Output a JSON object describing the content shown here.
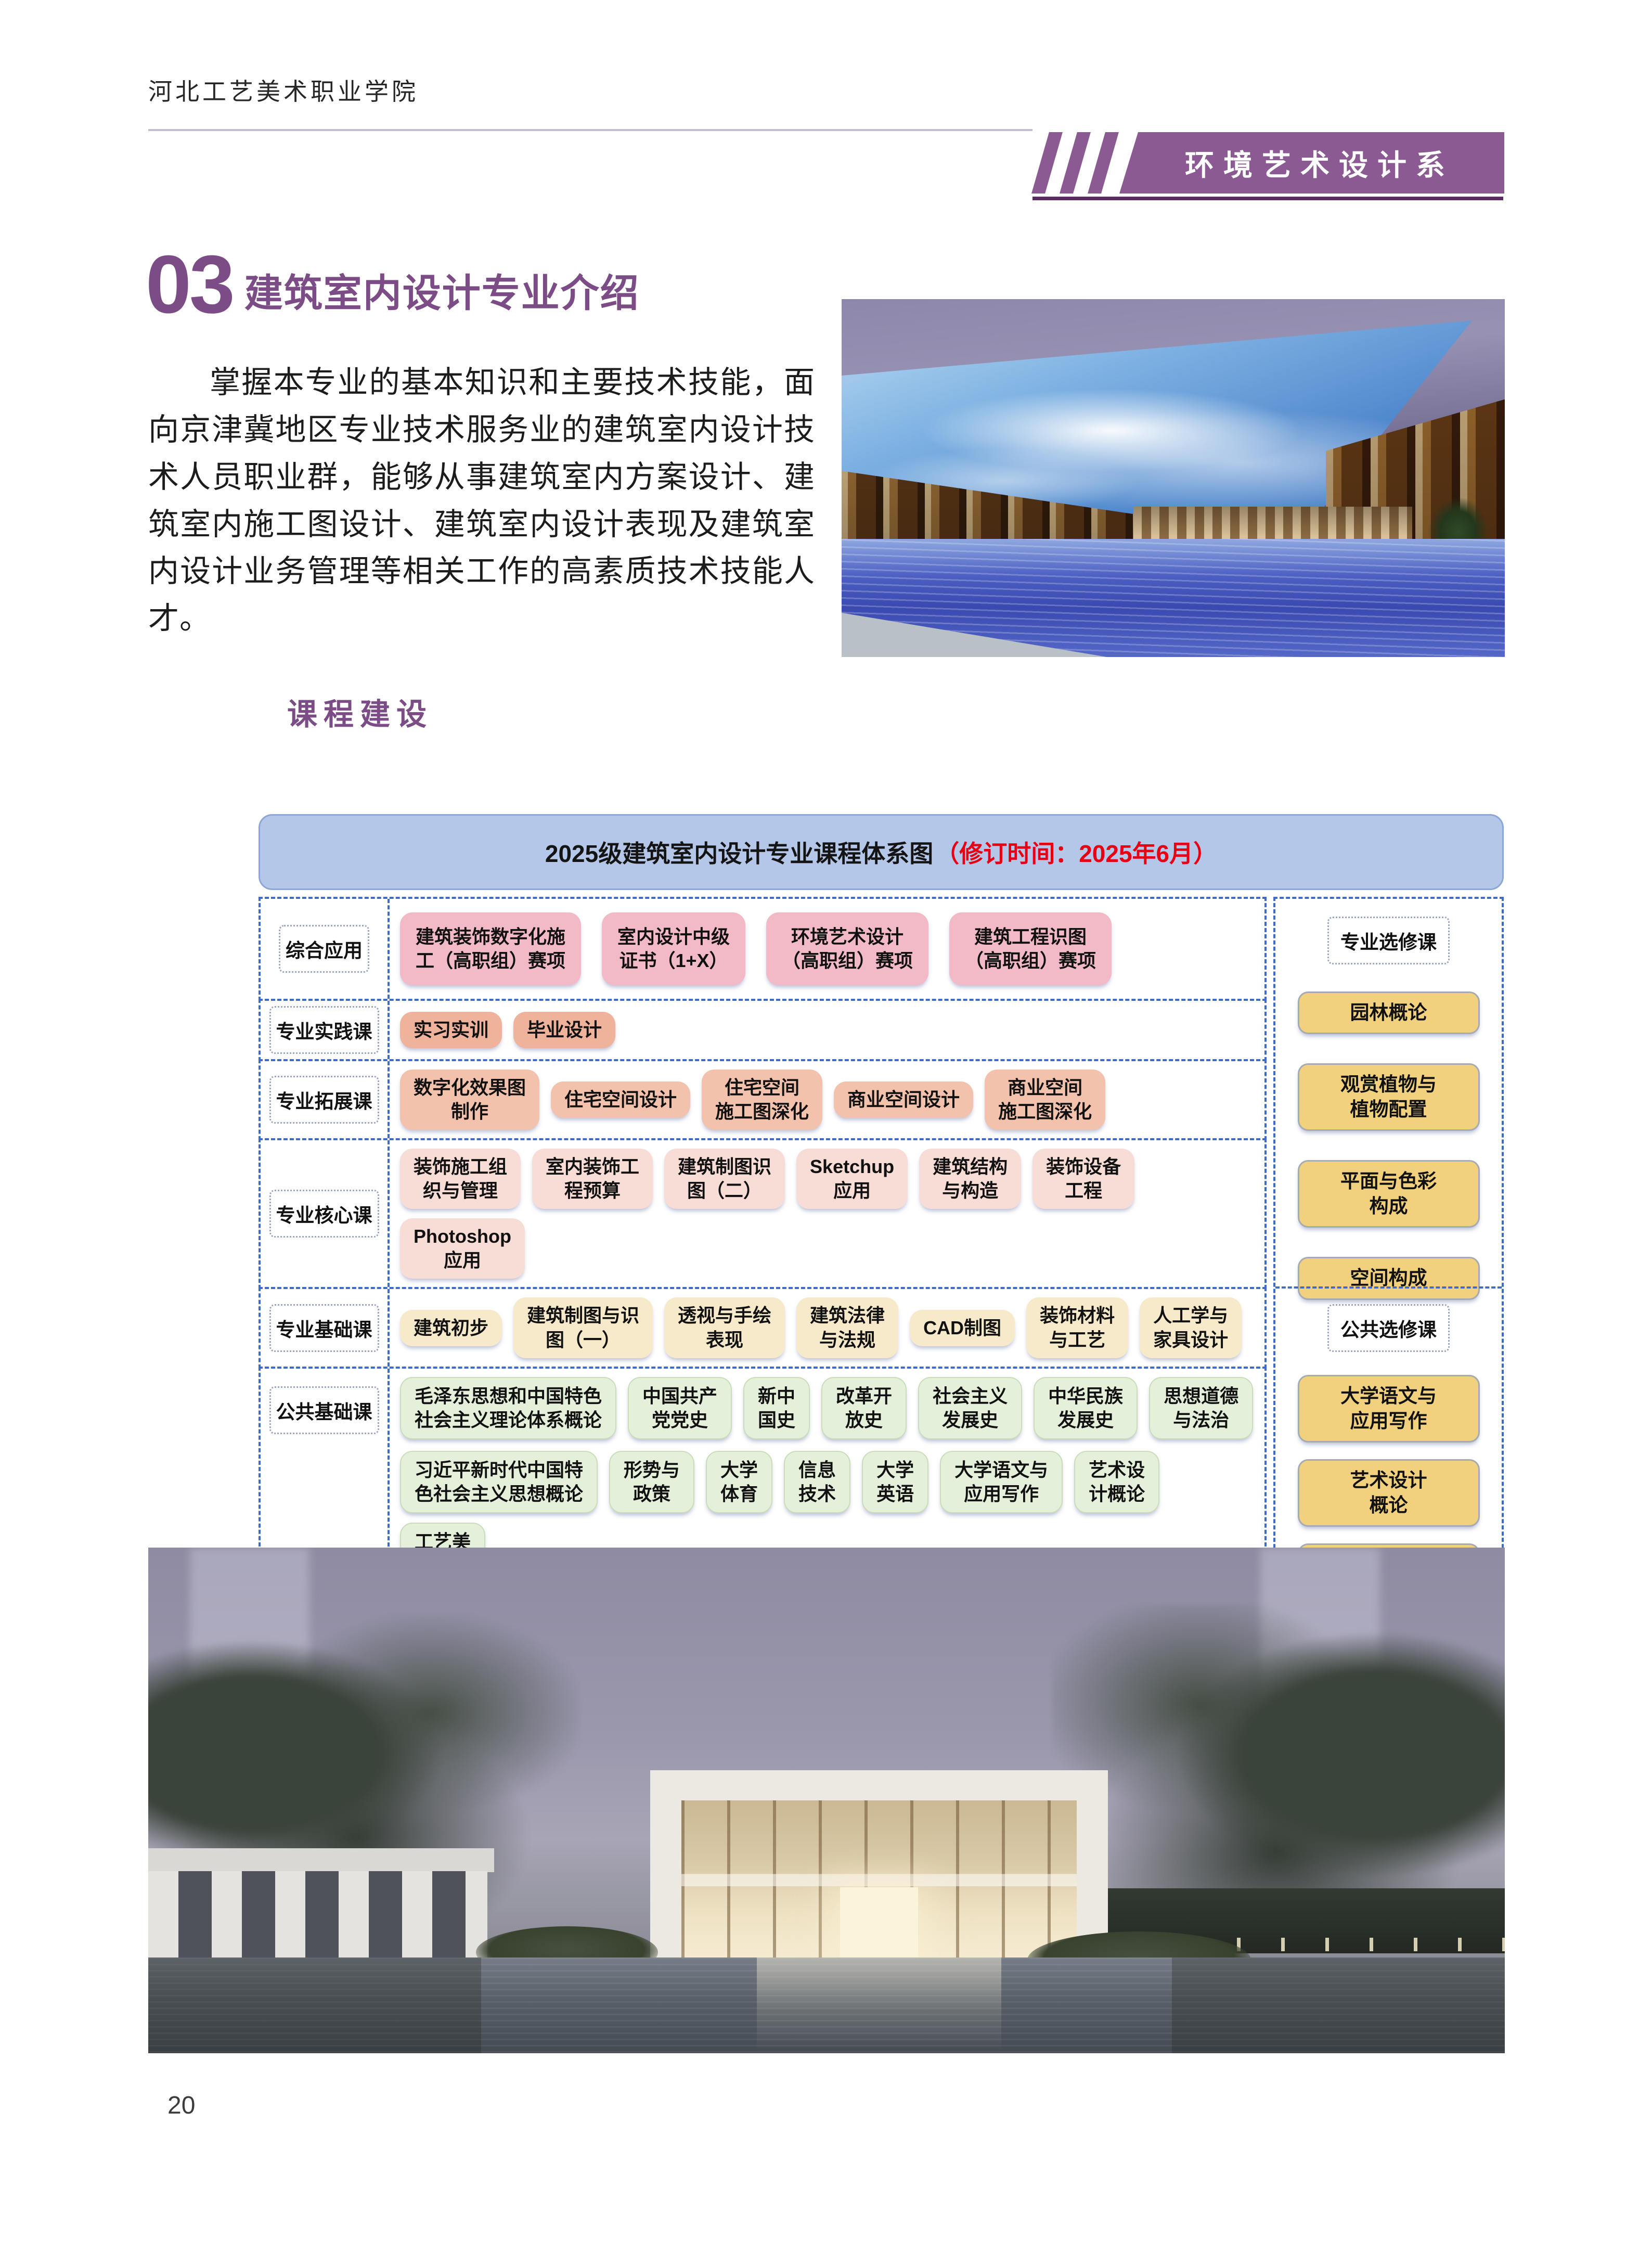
{
  "header": {
    "college_name": "河北工艺美术职业学院",
    "department_banner": "环境艺术设计系"
  },
  "section": {
    "number": "03",
    "title": "建筑室内设计专业介绍",
    "intro_paragraph": "掌握本专业的基本知识和主要技术技能，面向京津冀地区专业技术服务业的建筑室内设计技术人员职业群，能够从事建筑室内方案设计、建筑室内施工图设计、建筑室内设计表现及建筑室内设计业务管理等相关工作的高素质技术技能人才。",
    "courses_heading": "课程建设"
  },
  "diagram": {
    "title_main": "2025级建筑室内设计专业课程体系图",
    "title_note": "（修订时间：2025年6月）",
    "rows": [
      {
        "label": "综合应用",
        "palette": "pink",
        "lines": [
          [
            "建筑装饰数字化施\n工（高职组）赛项",
            "室内设计中级\n证书（1+X）",
            "环境艺术设计\n（高职组）赛项",
            "建筑工程识图\n（高职组）赛项"
          ]
        ]
      },
      {
        "label": "专业实践课",
        "palette": "salmon",
        "lines": [
          [
            "实习实训",
            "毕业设计"
          ]
        ]
      },
      {
        "label": "专业拓展课",
        "palette": "salmon2",
        "lines": [
          [
            "数字化效果图\n制作",
            "住宅空间设计",
            "住宅空间\n施工图深化",
            "商业空间设计",
            "商业空间\n施工图深化"
          ]
        ]
      },
      {
        "label": "专业核心课",
        "palette": "rose",
        "lines": [
          [
            "装饰施工组\n织与管理",
            "室内装饰工\n程预算",
            "建筑制图识\n图（二）",
            "Sketchup\n应用",
            "建筑结构\n与构造",
            "装饰设备\n工程",
            "Photoshop\n应用"
          ]
        ]
      },
      {
        "label": "专业基础课",
        "palette": "cream",
        "lines": [
          [
            "建筑初步",
            "建筑制图与识\n图（一）",
            "透视与手绘\n表现",
            "建筑法律\n与法规",
            "CAD制图",
            "装饰材料\n与工艺",
            "人工学与\n家具设计"
          ]
        ]
      },
      {
        "label": "公共基础课",
        "palette": "green",
        "lines": [
          [
            "毛泽东思想和中国特色\n社会主义理论体系概论",
            "中国共产\n党党史",
            "新中\n国史",
            "改革开\n放史",
            "社会主义\n发展史",
            "中华民族\n发展史",
            "思想道德\n与法治"
          ],
          [
            "习近平新时代中国特\n色社会主义思想概论",
            "形势与\n政策",
            "大学\n体育",
            "信息\n技术",
            "大学\n英语",
            "大学语文与\n应用写作",
            "艺术设\n计概论",
            "工艺美\n术史"
          ],
          [
            "大学生职业生涯\n规划与就业指导",
            "大学生创新\n创业教育",
            "军事理论",
            "军事技能",
            "大学生心理\n健康教育",
            "劳动\n教育",
            "国家安全教育\n公共基础课"
          ]
        ]
      }
    ],
    "electives": [
      {
        "label": "专业选修课",
        "courses": [
          "园林概论",
          "观赏植物与\n植物配置",
          "平面与色彩\n构成",
          "空间构成"
        ]
      },
      {
        "label": "公共选修课",
        "courses": [
          "大学语文与\n应用写作",
          "艺术设计\n概论",
          "工艺美术史"
        ]
      }
    ]
  },
  "footer": {
    "page_number": "20"
  },
  "colors": {
    "accent_purple": "#7c4c86",
    "banner_purple": "#8b5a92",
    "banner_underline_purple": "#5b2b64",
    "note_red": "#e60013",
    "diagram_border_blue": "#3d6bc5",
    "title_bar_blue": "#b5c7e9",
    "row_pink": "#f2bac6",
    "row_salmon": "#efb29a",
    "row_salmon_light": "#f2c2ac",
    "row_rose": "#f8dcd6",
    "row_cream": "#f7eacb",
    "row_green": "#e5f0db",
    "elective_yellow": "#f1d17d"
  }
}
